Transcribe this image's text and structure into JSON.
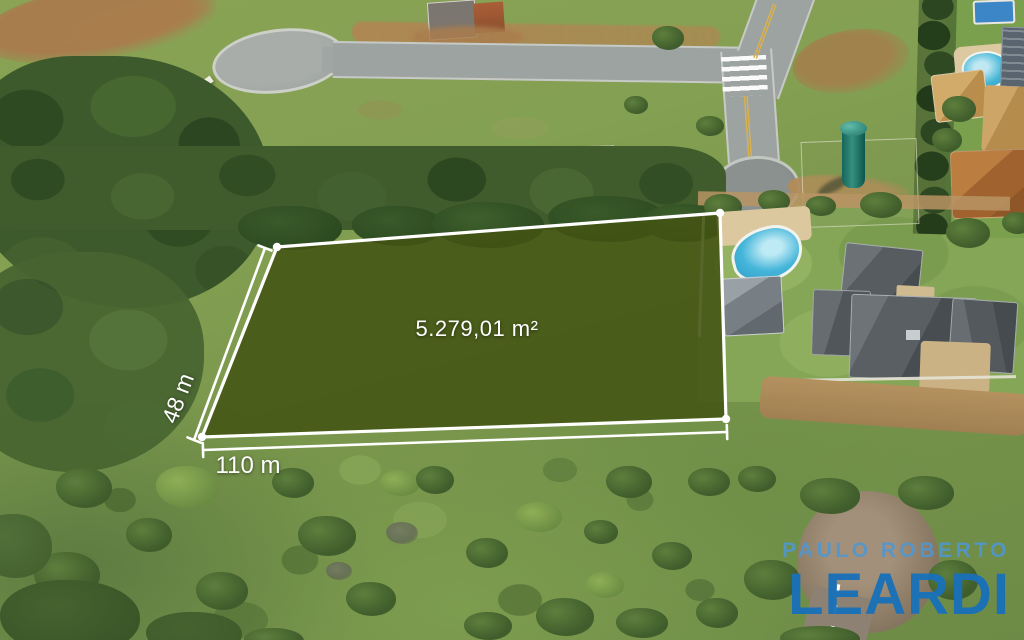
{
  "parcel": {
    "area_label": "5.279,01 m²",
    "frontage_label": "110 m",
    "depth_label": "48 m",
    "fill_color": "rgba(67,84,19,0.88)",
    "stroke_color": "#ffffff"
  },
  "brand": {
    "line1": "PAULO ROBERTO",
    "line2": "LEARDI",
    "line1_color": "#5097d1",
    "line2_color": "#1a71b8"
  }
}
